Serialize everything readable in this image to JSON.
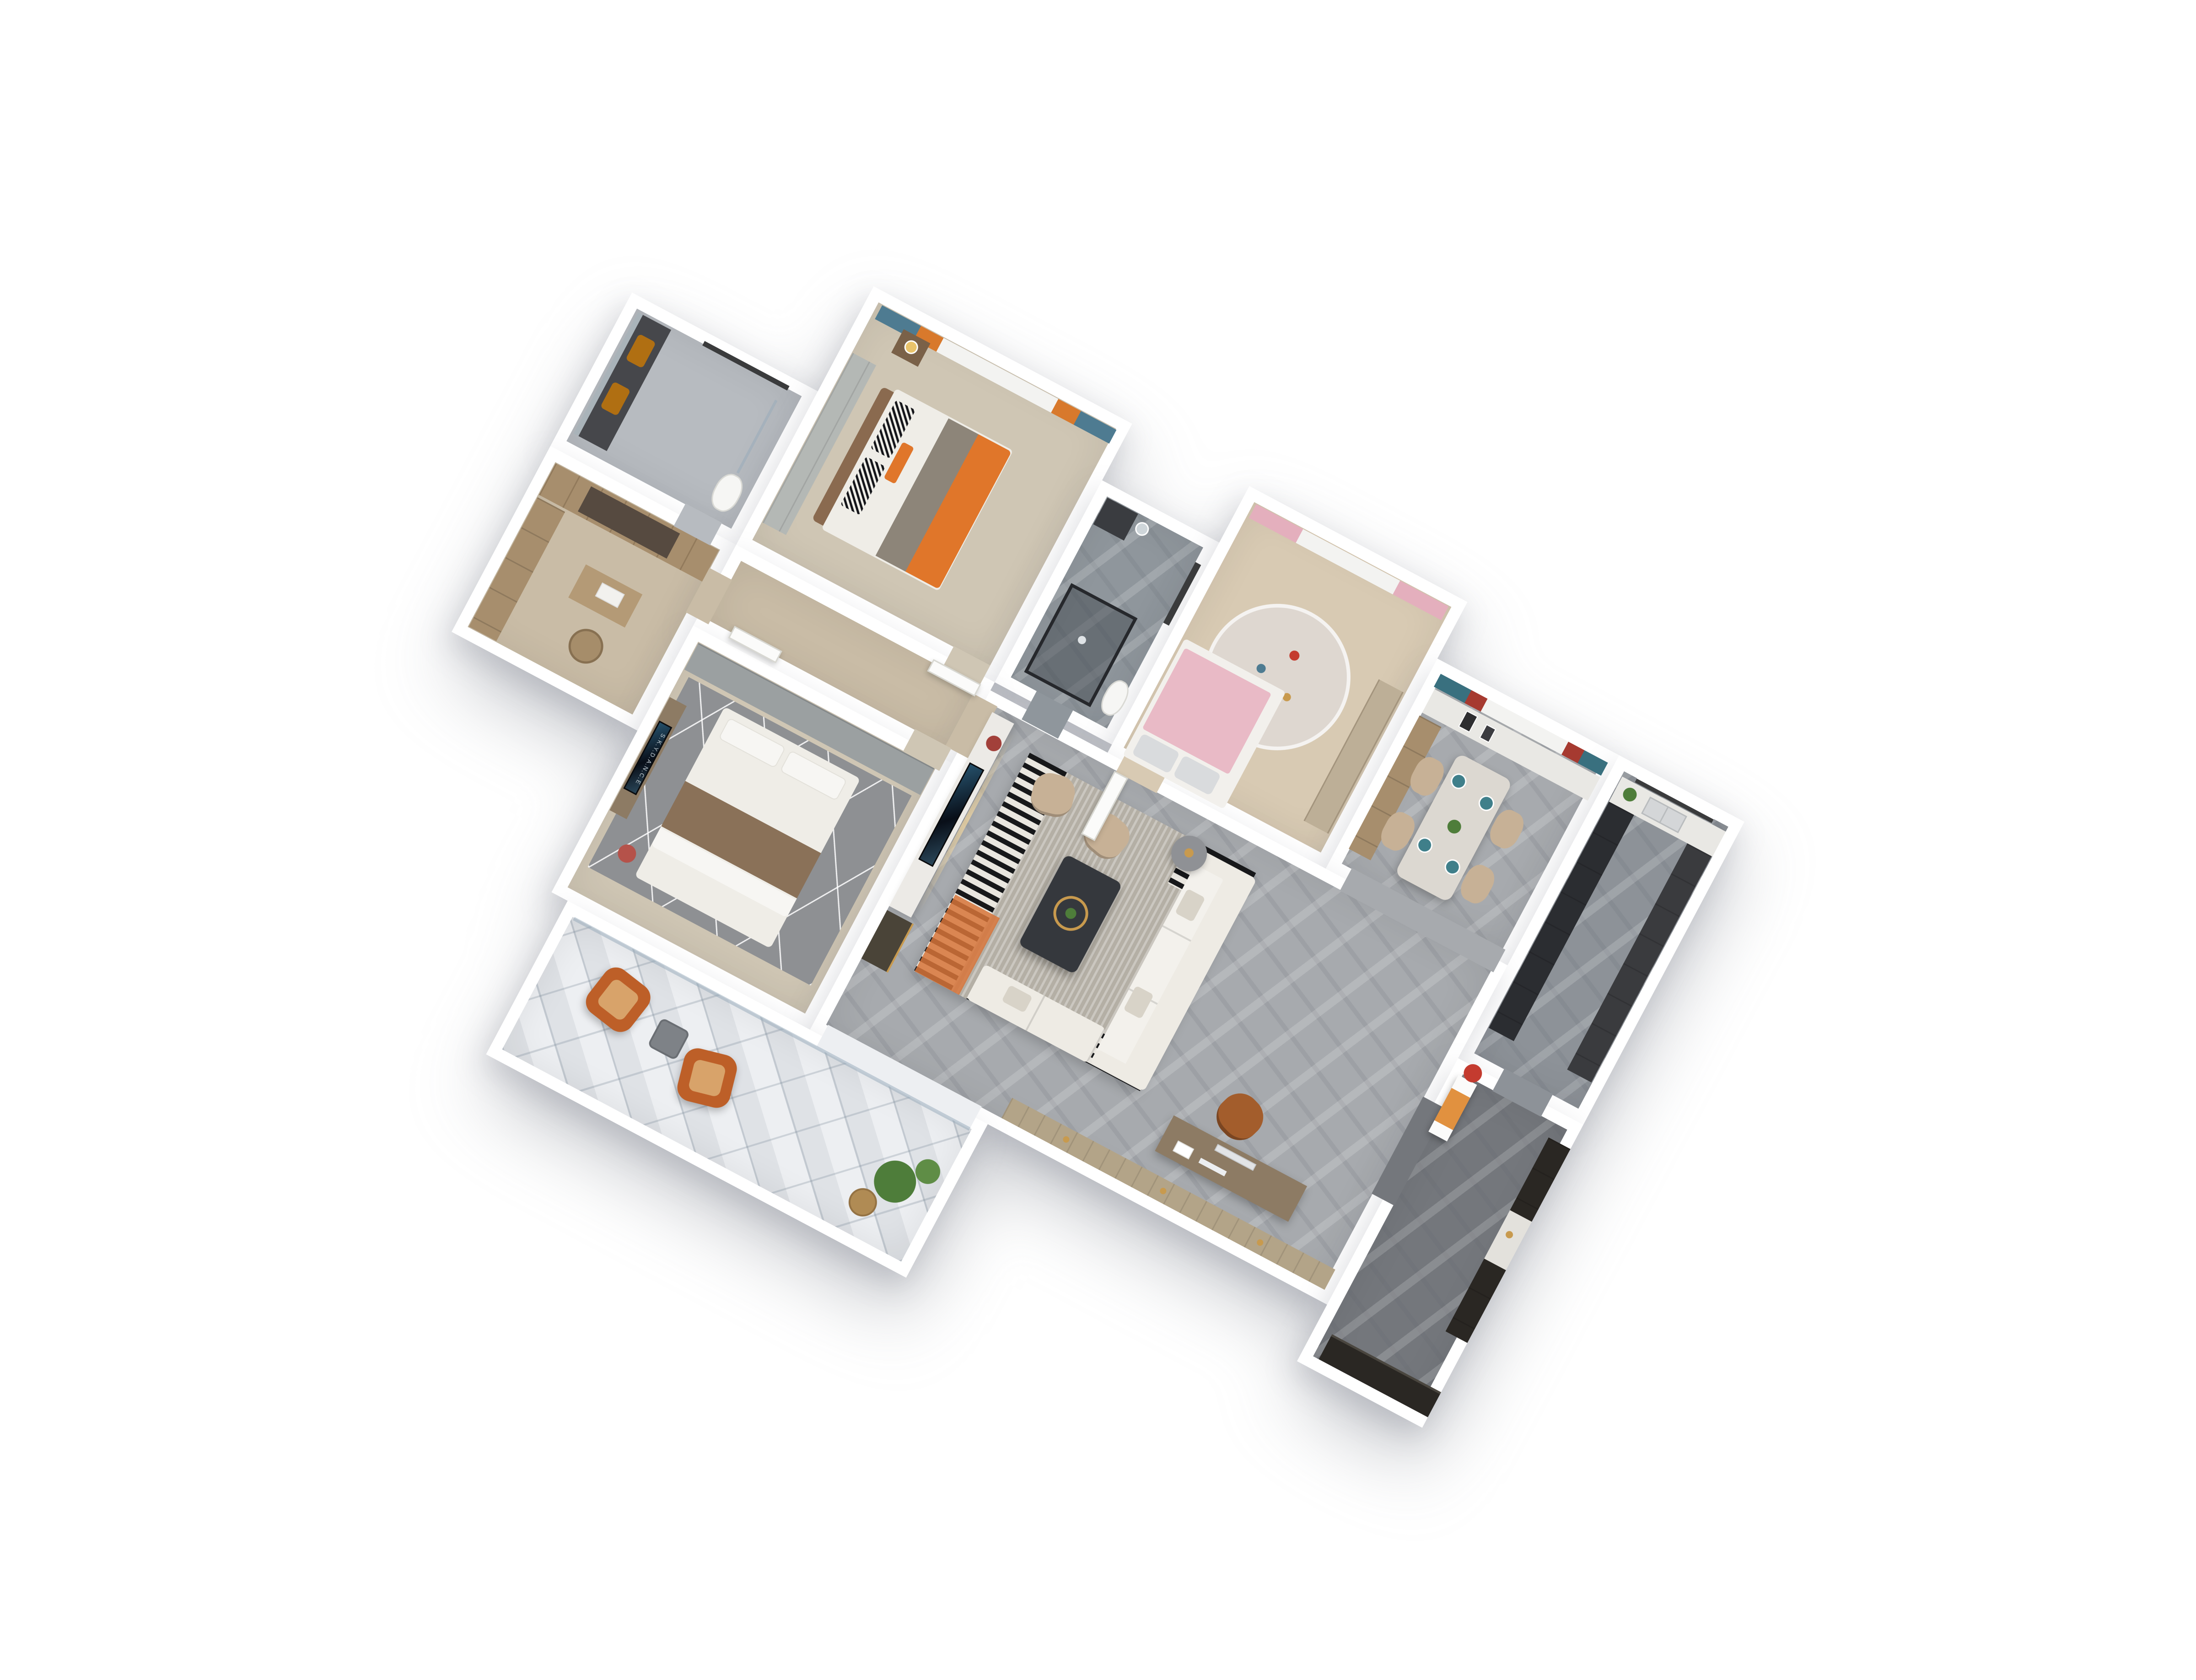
{
  "scene": {
    "background": "#ffffff",
    "description": "3D top-down dollhouse floor plan of an apartment, rotated on white background"
  },
  "texts": {
    "tv_logo": "S.K.Y.D.A.N.C.E"
  },
  "palette": {
    "wall": "#ffffff",
    "tile_bath": "#b7bbc0",
    "tile_shower": "#8f969c",
    "wood_light": "#cfc6b4",
    "wood_warm": "#c9bca6",
    "wood_kids": "#d8cab3",
    "wood_mid": "#bdaf97",
    "marble_gray": "#a7aaae",
    "marble_kitchen": "#8d9298",
    "marble_dark": "#74777c",
    "balcony_tile": "#edeff2",
    "vanity_dark": "#46474b",
    "mirror_glass": "#a9b3b9",
    "sink_amber": "#b06f12",
    "window_frame": "#3a3b3c",
    "cabinet_wood": "#a78e6d",
    "wardrobe_glass": "#564a40",
    "table_wood": "#b49a76",
    "stool_rattan": "#a68d6a",
    "wardrobe_gray": "#b4b8b5",
    "nightstand_wood": "#7a6148",
    "lamp_gold": "#e9c36b",
    "headboard_brown": "#8a6a4f",
    "bedding_white": "#efede7",
    "duvet_gray": "#8d8579",
    "blanket_orange": "#e0762a",
    "curtain_blue": "#4e7b91",
    "curtain_orange": "#d8792c",
    "curtain_sheer": "#f3f3f1",
    "curtain_pink": "#e4afbd",
    "curtain_teal": "#39707f",
    "curtain_red": "#a63a30",
    "vanity_small": "#3a3c40",
    "glass_shower": "rgba(58,64,72,0.45)",
    "rug_kids": "#ded7d0",
    "blanket_pink": "#e9bac6",
    "pillow_silver": "#d9dbdd",
    "bedframe_white": "#f2f0ec",
    "counter_white": "#e9e8e4",
    "table_marble": "#dcd8d1",
    "plate_teal": "#3f7f8a",
    "chair_beige": "#c7b196",
    "plant_green": "#4e7d3a",
    "plant_light": "#5f8d46",
    "cabinet_dark": "#2b2d31",
    "cabinet_graphite": "#3a3b3e",
    "closet_gray": "#9ba0a1",
    "rug_gray": "#8e9093",
    "pillow_white": "#f7f6f3",
    "blanket_brown": "#8a7158",
    "console_wood": "#8d7b64",
    "tv_black": "#14161a",
    "cushion_red": "#b5524a",
    "marble_tv_wall": "#eceae6",
    "console_dark": "#4a4438",
    "vase_red": "#a2403a",
    "rug_living": "#b4afa5",
    "rug_orange": "#d7743a",
    "sofa_white": "#eeebe4",
    "sofa_seat": "#f3f1ec",
    "sofa_pillow": "#d8d3c8",
    "table_dark": "#35383d",
    "tray_gold": "#c89a4e",
    "side_table": "#8f9195",
    "imac": "#e2e4e6",
    "chair_leather": "#a35d2c",
    "sideboard_wood": "#b3a488",
    "niche_white": "#e3e1dc",
    "cabinet_espresso": "#2a2723",
    "bench_orange": "#e1913f",
    "flower_red": "#c43b2f",
    "leather_rust": "#bd5f28",
    "cushion_tan": "#d8a36a",
    "balcony_table": "#7e8287",
    "basket_tan": "#b08b54",
    "door_white": "#fbfbfa",
    "glass_rail": "rgba(150,170,185,0.5)"
  }
}
